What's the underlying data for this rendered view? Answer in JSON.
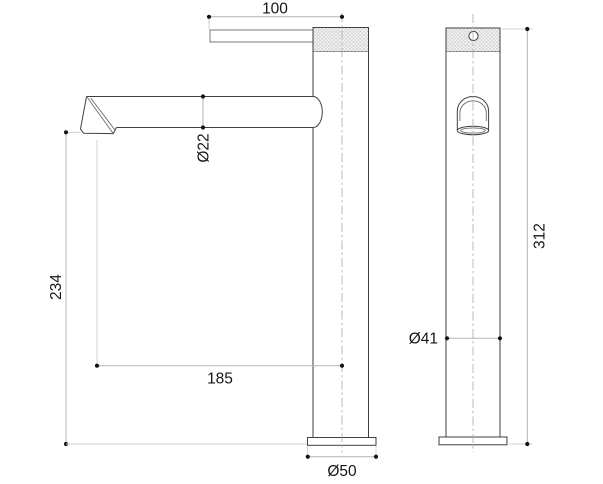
{
  "dimensions": {
    "handle_offset": "100",
    "spout_diameter": "Ø22",
    "outlet_height": "234",
    "spout_reach": "185",
    "base_diameter": "Ø50",
    "body_diameter": "Ø41",
    "total_height": "312"
  },
  "colors": {
    "background": "#ffffff",
    "outline": "#3f3f3f",
    "dimension_line": "#b3b3b3",
    "extension_line": "#d2d2d2",
    "centerline": "#ababab",
    "dimension_dot": "#141414",
    "hatch_line": "#bdbdbd",
    "hatch_fill": "#f3f3f3",
    "label_text": "#161616"
  }
}
